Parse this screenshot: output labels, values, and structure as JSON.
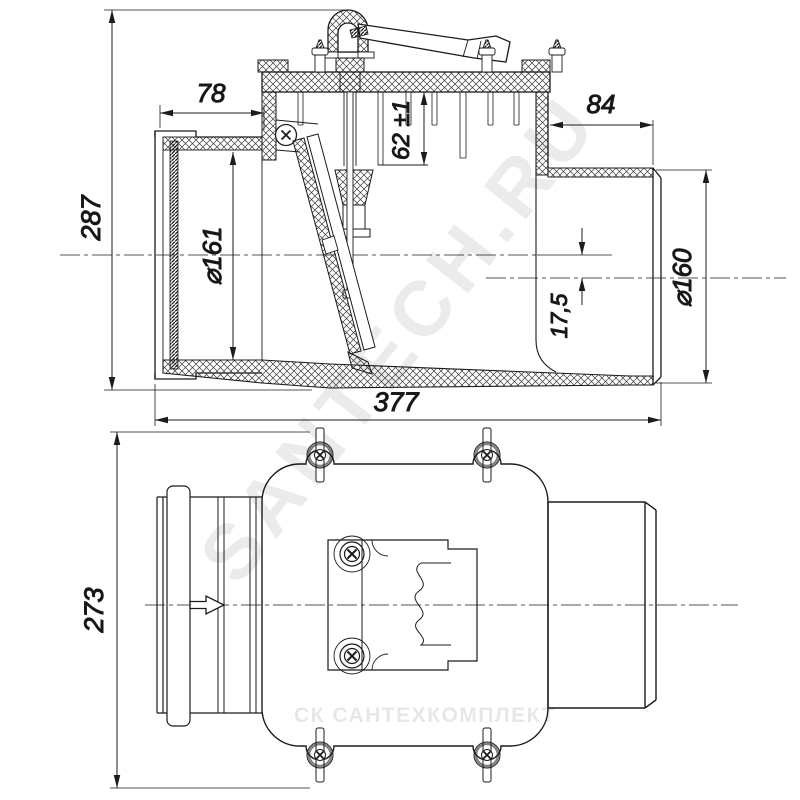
{
  "drawing": {
    "dimensions": {
      "overall_height": "287",
      "socket_depth": "78",
      "spigot_length": "84",
      "cover_to_seat": "62 ±1",
      "socket_bore": "⌀161",
      "spigot_diameter": "⌀160",
      "axis_offset": "17,5",
      "overall_length": "377",
      "overall_width": "273"
    },
    "watermarks": {
      "diagonal": "SANTECH.RU",
      "footer": "СК САНТЕХКОМПЛЕКТ"
    },
    "colors": {
      "line": "#1b1b1b",
      "background": "#ffffff",
      "watermark": "#000000"
    }
  }
}
